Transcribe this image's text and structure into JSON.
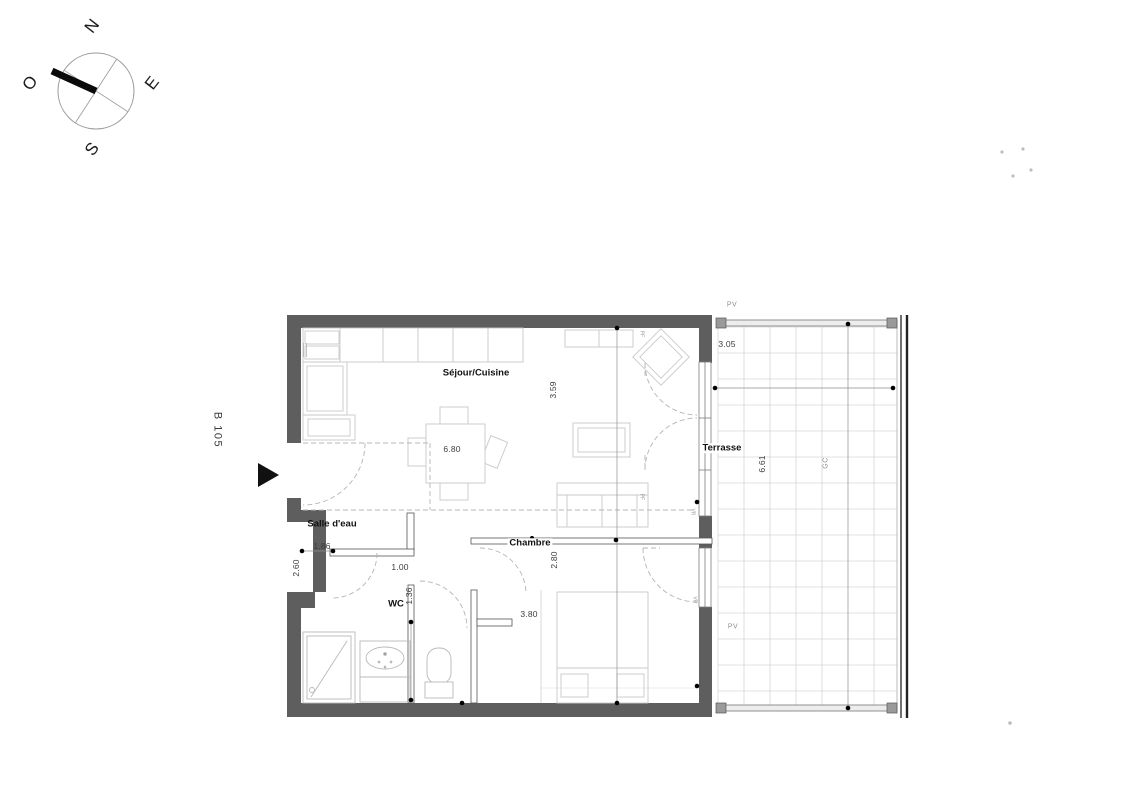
{
  "compass": {
    "north": "N",
    "west": "O",
    "east": "E",
    "south": "S"
  },
  "unit": {
    "label": "B 105"
  },
  "rooms": {
    "sejour": "Séjour/Cuisine",
    "salle_deau": "Salle d'eau",
    "wc": "WC",
    "chambre": "Chambre",
    "terrasse": "Terrasse"
  },
  "dims": {
    "sejour_width": "6.80",
    "sejour_depth": "3.59",
    "entry_wall": "2.60",
    "salle_deau_width": "1.86",
    "door_width": "1.00",
    "wc_depth": "1.36",
    "chambre_width": "3.80",
    "chambre_depth": "2.80",
    "terrasse_width": "3.05",
    "terrasse_depth": "6.61"
  },
  "marks": {
    "pv_top": "PV",
    "pv_bottom": "PV",
    "gc": "GC",
    "pf_top": "PF",
    "pf_bottom": "PF",
    "vr_sejour": "VR",
    "vr_chambre": "VR"
  },
  "colors": {
    "wall": "#5e5e5e",
    "furniture_line": "#c9c9c9",
    "dash": "#b5b5b5",
    "grid": "#c6c6c6",
    "label": "#111111",
    "dim_text": "#3d3d3d"
  }
}
